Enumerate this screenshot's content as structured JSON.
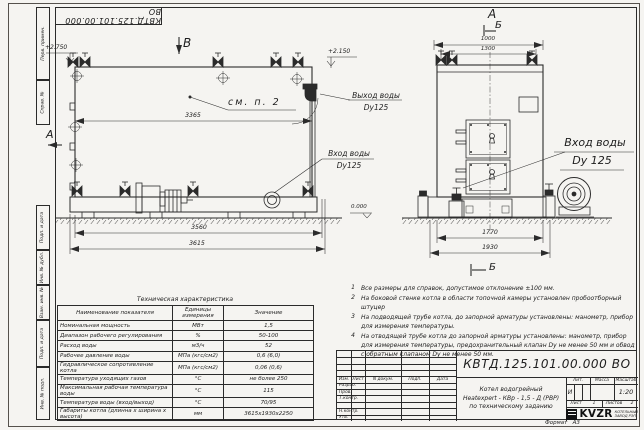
{
  "designation": "КВТД.125.101.00.000  ВО",
  "frame": {
    "margin_labels": [
      "Перв. примен.",
      "Справ. №",
      "Подп. и дата",
      "Инв. № дубл.",
      "Взам. инв. №",
      "Подп. и дата",
      "Инв. № подл."
    ],
    "format_label": "Формат",
    "format_value": "А3"
  },
  "side_view": {
    "view_letter": "В",
    "section_letter": "А",
    "elev_top": "+2.750",
    "elev_outlet": "+2.150",
    "elev_ground": "0.000",
    "see_note": "см. п. 2",
    "dim_body": "3365",
    "dim_base": "3560",
    "dim_overall": "3615",
    "outlet_line1": "Выход воды",
    "outlet_line2": "Dy125",
    "inlet_line1": "Вход воды",
    "inlet_line2": "Dy125"
  },
  "front_view": {
    "view_letter_a": "А",
    "view_letter_b": "Б",
    "section_letter_b": "Б",
    "dim_top": "1000",
    "dim_collector": "1300",
    "dim_base": "1770",
    "dim_overall": "1930",
    "inlet_line1": "Вход воды",
    "inlet_line2": "Dy 125"
  },
  "notes": [
    {
      "num": "1",
      "text": "Все размеры для справок, допустимое отклонение ±100 мм."
    },
    {
      "num": "2",
      "text": "На боковой стенке котла в области топочной камеры установлен пробоотборный штуцер"
    },
    {
      "num": "3",
      "text": "На  подводящей трубе котла, до запорной арматуры установлены: манометр, прибор для измерения температуры."
    },
    {
      "num": "4",
      "text": "На отводящей трубе котла до запорной арматуры установлены: манометр, прибор для измерения температуры, предохранительный клапан Dу не менее 50 мм и обвод с обратным клапаном Dу не менее 50 мм."
    }
  ],
  "spec_table": {
    "title": "Техническая характеристика",
    "headers": [
      "Наименование показателя",
      "Единицы измерения",
      "Значение"
    ],
    "rows": [
      [
        "Номинальная мощность",
        "МВт",
        "1,5"
      ],
      [
        "Диапазон рабочего регулирования",
        "%",
        "50-100"
      ],
      [
        "Расход воды",
        "м3/ч",
        "52"
      ],
      [
        "Рабочее давление воды",
        "МПа (кгс/см2)",
        "0,6 (6,0)"
      ],
      [
        "Гидравлическое сопротивление котла",
        "МПа (кгс/см2)",
        "0,06 (0,6)"
      ],
      [
        "Температура уходящих газов",
        "°С",
        "не более 250"
      ],
      [
        "Максимальная рабочая температура воды",
        "°С",
        "115"
      ],
      [
        "Температура воды (вход/выход)",
        "°С",
        "70/95"
      ],
      [
        "Габариты котла (длинна х ширина х высота)",
        "мм",
        "3615х1930х2250"
      ]
    ]
  },
  "title_block": {
    "name_line1": "Котел водогрейный",
    "name_line2": "Heatexpert - КВр - 1,5 - Д (РВР)",
    "name_line3": "по техническому заданию",
    "header_cols": [
      "Изм.",
      "Лист",
      "N докум.",
      "Подп.",
      "Дата"
    ],
    "row_labels": [
      "Разраб.",
      "Пров.",
      "Т.контр.",
      "Н.контр.",
      "Утв."
    ],
    "lit_header": "Лит.",
    "lit_value": "И",
    "mass_header": "Масса",
    "scale_header": "Масштаб",
    "scale_value": "1:20",
    "sheet_label": "Лист",
    "sheet_value": "1",
    "sheets_label": "Листов",
    "sheets_value": "2",
    "company_logo": "KVZR",
    "company_name1": "КОТЕЛЬНЫЙ",
    "company_name2": "ЗАВОД РЭП"
  }
}
